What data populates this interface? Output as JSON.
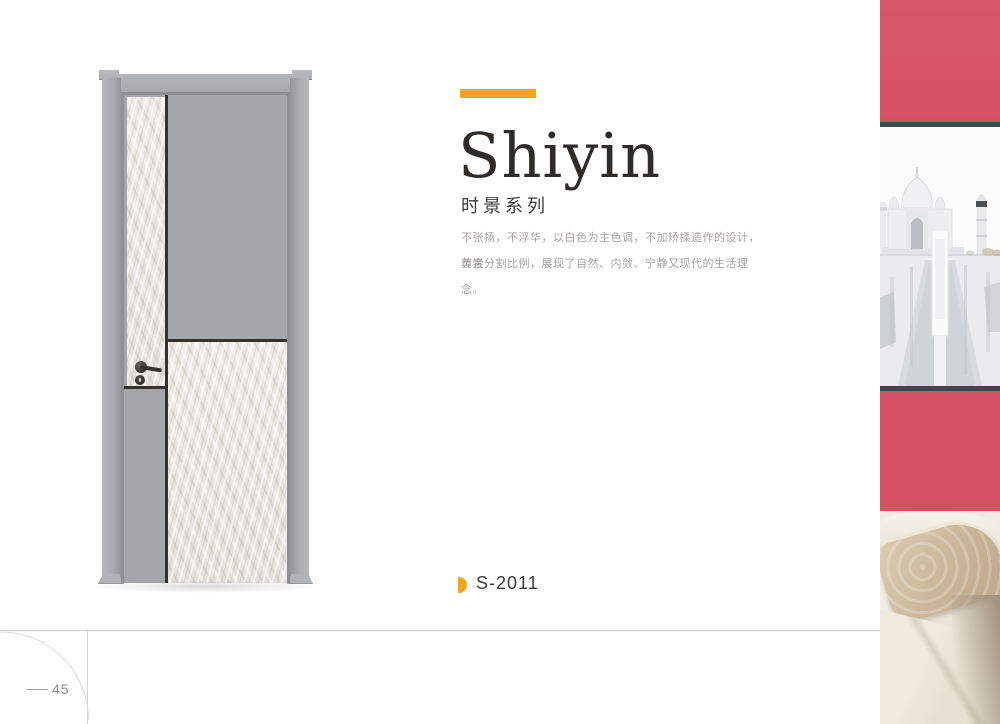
{
  "hero": {
    "title": "Shiyin",
    "series": "时景系列",
    "description": [
      "不张扬，不浮华，以白色为主色调，不加矫揉造作的设计，尊崇",
      "黄金分割比例，展现了自然、内敛、宁静又现代的生活理念。"
    ]
  },
  "product": {
    "code": "S-2011"
  },
  "footer": {
    "page_number": "45"
  },
  "door": {
    "style": "two-tone door: gray lacquer panels with light plaster-texture inlays, thin dark accent lines, gray frame",
    "hardware": "dark lever handle with round rosette and keyhole escutcheon"
  },
  "photo_strip": {
    "framed_art_subject": "taj-mahal-print",
    "scene": "red wall with framed art above cream sofa and beige pillow"
  },
  "colors": {
    "accent_orange": "#f5a41c",
    "wall_red": "#d55162",
    "door_frame_gray": "#a9acaf",
    "door_panel_gray": "#a3a6aa",
    "door_texture_light": "#e9e6e0",
    "accent_line_dark": "#35322e",
    "art_frame_dark": "#41454d",
    "sofa_cream": "#ebe5d9",
    "pillow_beige": "#c9b599",
    "text_dark": "#2e2b29",
    "text_muted": "#a6a3a0"
  }
}
